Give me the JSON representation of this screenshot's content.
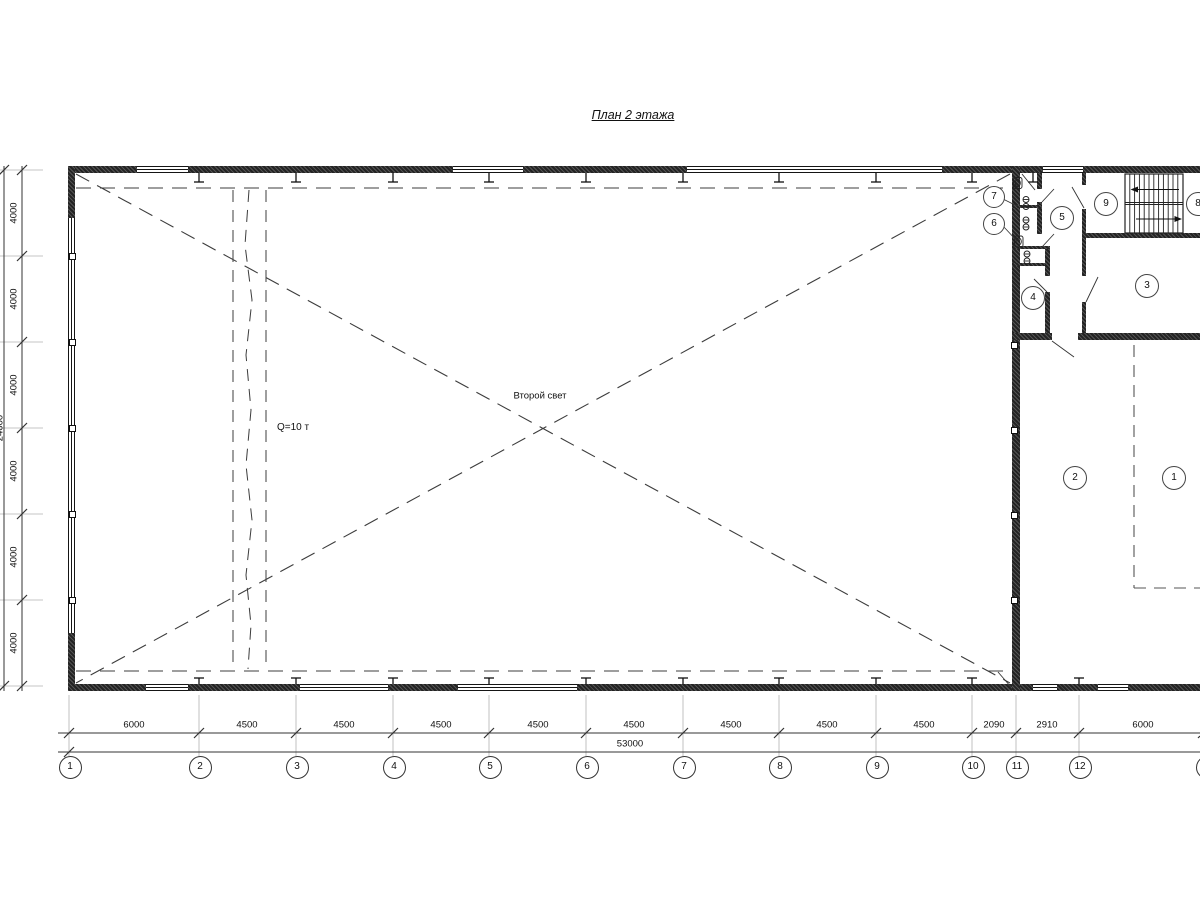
{
  "title": "План 2 этажа",
  "labels": {
    "second_light": "Второй свет",
    "crane_capacity": "Q=10 т"
  },
  "grid": {
    "axis_labels": [
      "1",
      "2",
      "3",
      "4",
      "5",
      "6",
      "7",
      "8",
      "9",
      "10",
      "11",
      "12"
    ],
    "axis_label_cut": ""
  },
  "dimensions": {
    "bottom_segments": [
      "6000",
      "4500",
      "4500",
      "4500",
      "4500",
      "4500",
      "4500",
      "4500",
      "4500",
      "2090",
      "2910",
      "6000"
    ],
    "bottom_total": "53000",
    "left_segments": [
      "4000",
      "4000",
      "4000",
      "4000",
      "4000",
      "4000"
    ],
    "left_total": "24000"
  },
  "rooms": {
    "numbers": [
      "1",
      "2",
      "3",
      "4",
      "5",
      "6",
      "7",
      "8",
      "9"
    ]
  }
}
